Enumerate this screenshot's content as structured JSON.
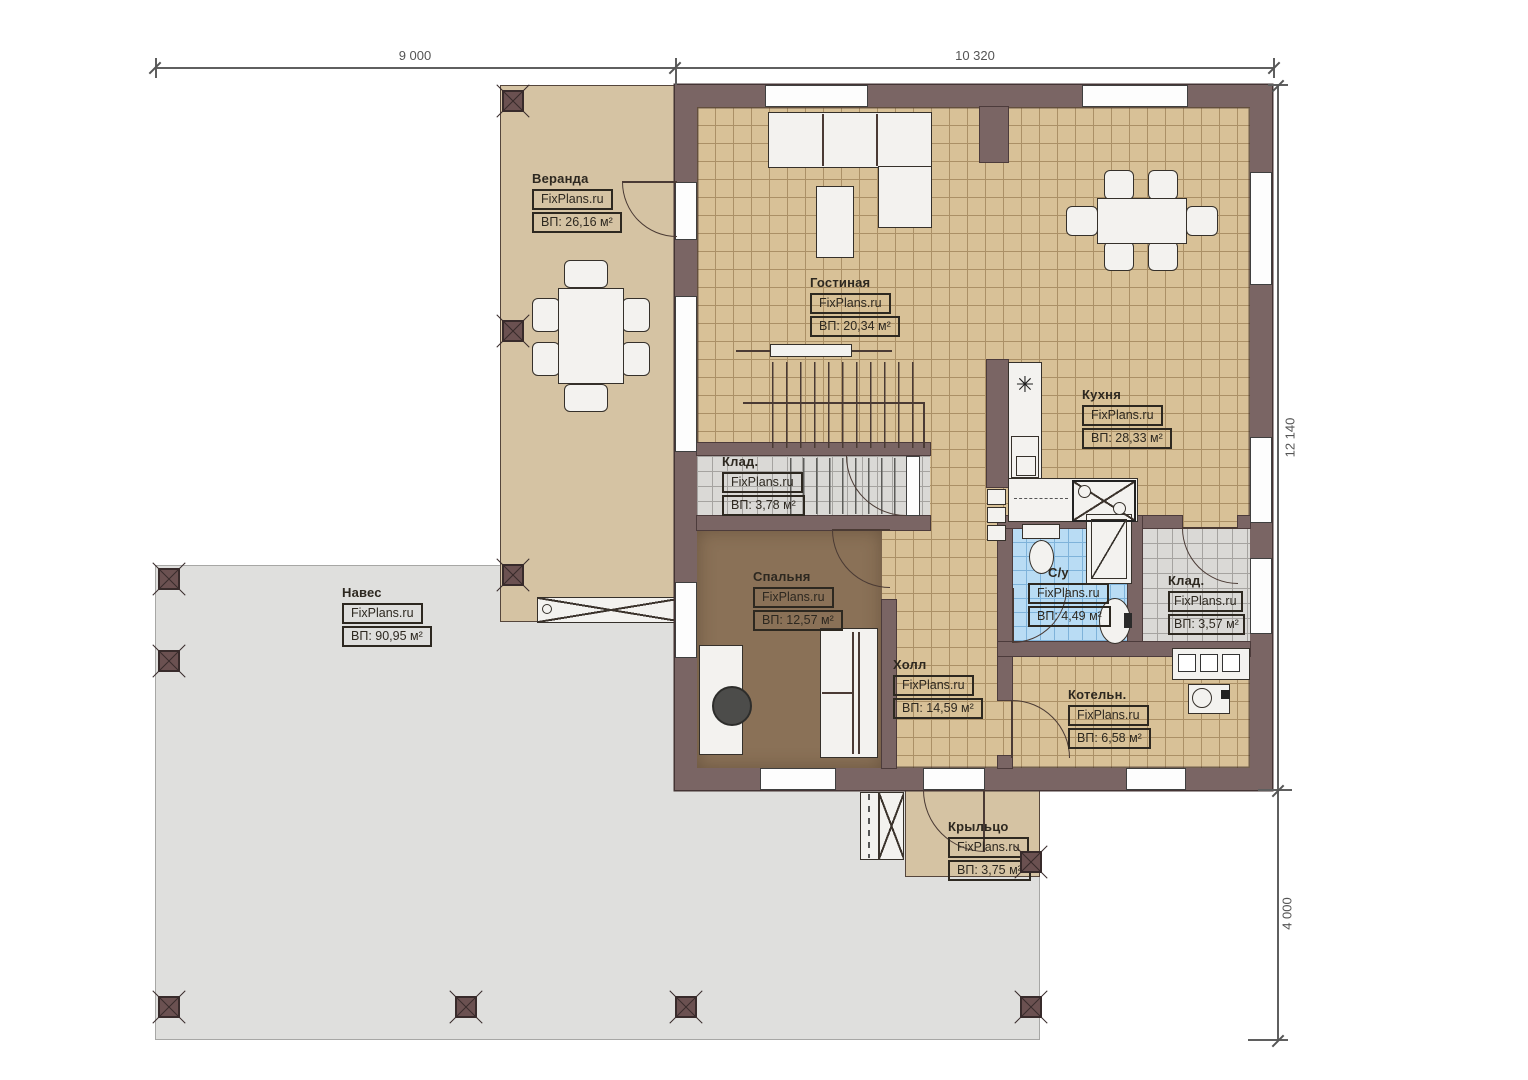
{
  "dimensions": {
    "top_left": "9 000",
    "top_right": "10 320",
    "right_upper": "12 140",
    "right_lower": "4 000"
  },
  "rooms": {
    "veranda": {
      "name": "Веранда",
      "brand": "FixPlans.ru",
      "area": "ВП: 26,16 м²"
    },
    "gostinaya": {
      "name": "Гостиная",
      "brand": "FixPlans.ru",
      "area": "ВП: 20,34 м²"
    },
    "kuhnya": {
      "name": "Кухня",
      "brand": "FixPlans.ru",
      "area": "ВП: 28,33 м²"
    },
    "klad1": {
      "name": "Клад.",
      "brand": "FixPlans.ru",
      "area": "ВП: 3,78 м²"
    },
    "spalnya": {
      "name": "Спальня",
      "brand": "FixPlans.ru",
      "area": "ВП: 12,57 м²"
    },
    "holl": {
      "name": "Холл",
      "brand": "FixPlans.ru",
      "area": "ВП: 14,59 м²"
    },
    "su": {
      "name": "С/у",
      "brand": "FixPlans.ru",
      "area": "ВП: 4,49 м²"
    },
    "klad2": {
      "name": "Клад.",
      "brand": "FixPlans.ru",
      "area": "ВП: 3,57 м²"
    },
    "kotelnaya": {
      "name": "Котельн.",
      "brand": "FixPlans.ru",
      "area": "ВП: 6,58 м²"
    },
    "naves": {
      "name": "Навес",
      "brand": "FixPlans.ru",
      "area": "ВП: 90,95 м²"
    },
    "krylco": {
      "name": "Крыльцо",
      "brand": "FixPlans.ru",
      "area": "ВП: 3,75 м²"
    }
  },
  "symbols": {
    "hob": "✳"
  },
  "colors": {
    "wall": "#7a6564",
    "floor": "#d8c197",
    "floor_grid": "#ab9066",
    "veranda": "#d5c3a3",
    "canopy": "#dfdfdd",
    "bath": "#b9dcf4",
    "bath_grid": "#7fb3da",
    "gray_tile": "#dad9d6",
    "gray_grid": "#a5a3a0",
    "bedroom": "#8a7157",
    "line": "#4a3a34",
    "fixture": "#f3f2ef"
  }
}
